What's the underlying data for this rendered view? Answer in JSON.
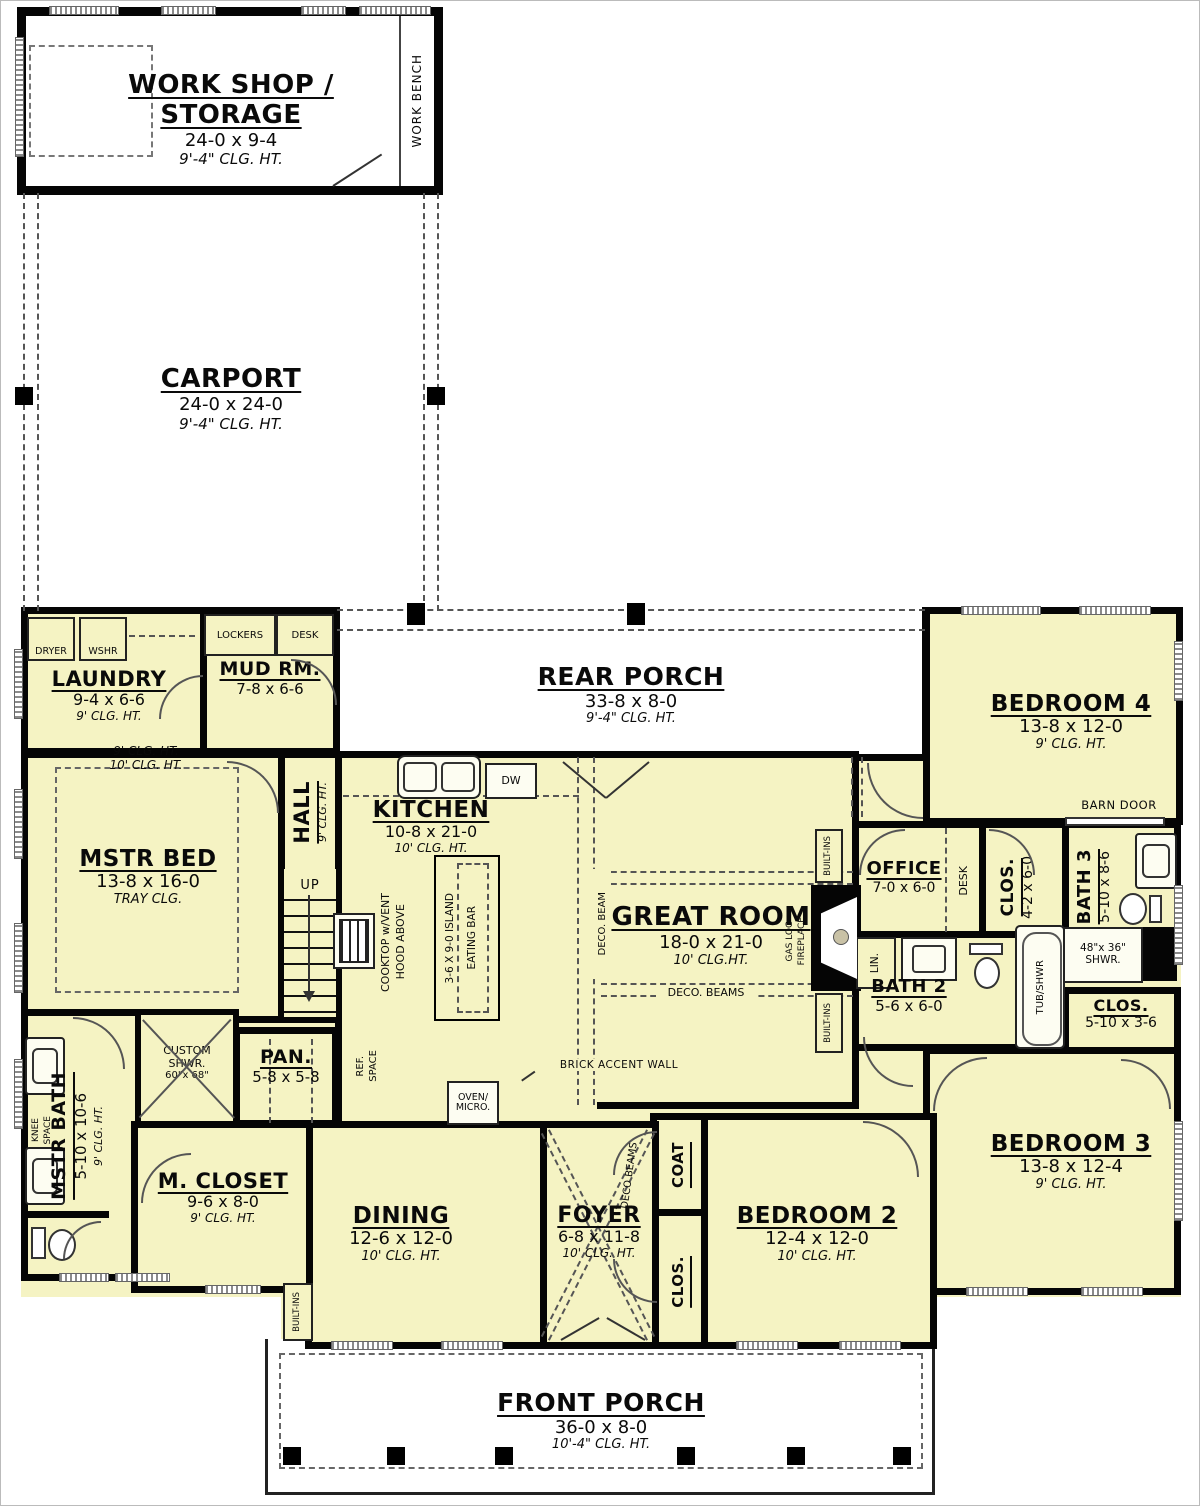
{
  "colors": {
    "room_fill": "#f5f3c3",
    "wall": "#050505",
    "porch": "#ffffff"
  },
  "rooms": {
    "workshop": {
      "name": "WORK SHOP / STORAGE",
      "dims": "24-0 x 9-4",
      "clg": "9'-4\" CLG. HT."
    },
    "carport": {
      "name": "CARPORT",
      "dims": "24-0 x 24-0",
      "clg": "9'-4\" CLG. HT."
    },
    "rear_porch": {
      "name": "REAR PORCH",
      "dims": "33-8 x 8-0",
      "clg": "9'-4\" CLG. HT."
    },
    "laundry": {
      "name": "LAUNDRY",
      "dims": "9-4 x 6-6",
      "clg": "9' CLG. HT."
    },
    "mud_rm": {
      "name": "MUD RM.",
      "dims": "7-8 x 6-6"
    },
    "bedroom4": {
      "name": "BEDROOM 4",
      "dims": "13-8 x 12-0",
      "clg": "9' CLG. HT."
    },
    "mstr_bed": {
      "name": "MSTR BED",
      "dims": "13-8 x 16-0",
      "clg": "TRAY CLG.",
      "clg_outer": "9' CLG. HT.",
      "clg_inner": "10' CLG. HT."
    },
    "hall": {
      "name": "HALL",
      "clg": "9' CLG. HT."
    },
    "kitchen": {
      "name": "KITCHEN",
      "dims": "10-8 x 21-0",
      "clg": "10' CLG. HT."
    },
    "great_room": {
      "name": "GREAT ROOM",
      "dims": "18-0 x 21-0",
      "clg": "10' CLG.HT."
    },
    "office": {
      "name": "OFFICE",
      "dims": "7-0 x 6-0"
    },
    "clos_hall": {
      "name": "CLOS.",
      "dims": "4-2 x 6-0"
    },
    "bath3": {
      "name": "BATH 3",
      "dims": "5-10 x 8-6"
    },
    "bath2": {
      "name": "BATH 2",
      "dims": "5-6 x 6-0"
    },
    "clos_bed3": {
      "name": "CLOS.",
      "dims": "5-10 x 3-6"
    },
    "bedroom3": {
      "name": "BEDROOM 3",
      "dims": "13-8 x 12-4",
      "clg": "9' CLG. HT."
    },
    "bedroom2": {
      "name": "BEDROOM 2",
      "dims": "12-4 x 12-0",
      "clg": "10' CLG. HT."
    },
    "coat": {
      "name": "COAT"
    },
    "clos_foyer": {
      "name": "CLOS."
    },
    "foyer": {
      "name": "FOYER",
      "dims": "6-8 x 11-8",
      "clg": "10' CLG. HT."
    },
    "dining": {
      "name": "DINING",
      "dims": "12-6 x 12-0",
      "clg": "10' CLG. HT."
    },
    "pan": {
      "name": "PAN.",
      "dims": "5-8 x 5-8"
    },
    "mstr_bath": {
      "name": "MSTR BATH",
      "dims": "5-10 x 10-6",
      "clg": "9' CLG. HT."
    },
    "m_closet": {
      "name": "M. CLOSET",
      "dims": "9-6 x 8-0",
      "clg": "9' CLG. HT."
    },
    "front_porch": {
      "name": "FRONT PORCH",
      "dims": "36-0 x 8-0",
      "clg": "10'-4\" CLG. HT."
    }
  },
  "fixtures": {
    "work_bench": "WORK BENCH",
    "dryer": "DRYER",
    "washer": "WSHR",
    "lockers": "LOCKERS",
    "desk_mud": "DESK",
    "desk_office": "DESK",
    "up": "UP",
    "dw": "DW",
    "cooktop_l1": "COOKTOP w/VENT",
    "cooktop_l2": "HOOD ABOVE",
    "island": "3-6 X 9-0 ISLAND",
    "eating_bar": "EATING BAR",
    "ref_l1": "REF.",
    "ref_l2": "SPACE",
    "oven_l1": "OVEN/",
    "oven_l2": "MICRO.",
    "deco_beam": "DECO. BEAM",
    "deco_beams": "DECO. BEAMS",
    "deco_beams_foyer": "DECO BEAMS",
    "gas_l1": "GAS LOG",
    "gas_l2": "FIREPLACE",
    "built_ins": "BUILT-INS",
    "lin": "LIN.",
    "tub_shwr": "TUB/SHWR",
    "shwr_l1": "48\"x 36\"",
    "shwr_l2": "SHWR.",
    "barn_door": "BARN DOOR",
    "knee_l1": "KNEE",
    "knee_l2": "SPACE",
    "custom_l1": "CUSTOM",
    "custom_l2": "SHWR.",
    "custom_l3": "60\"x 68\"",
    "brick": "BRICK ACCENT WALL"
  }
}
